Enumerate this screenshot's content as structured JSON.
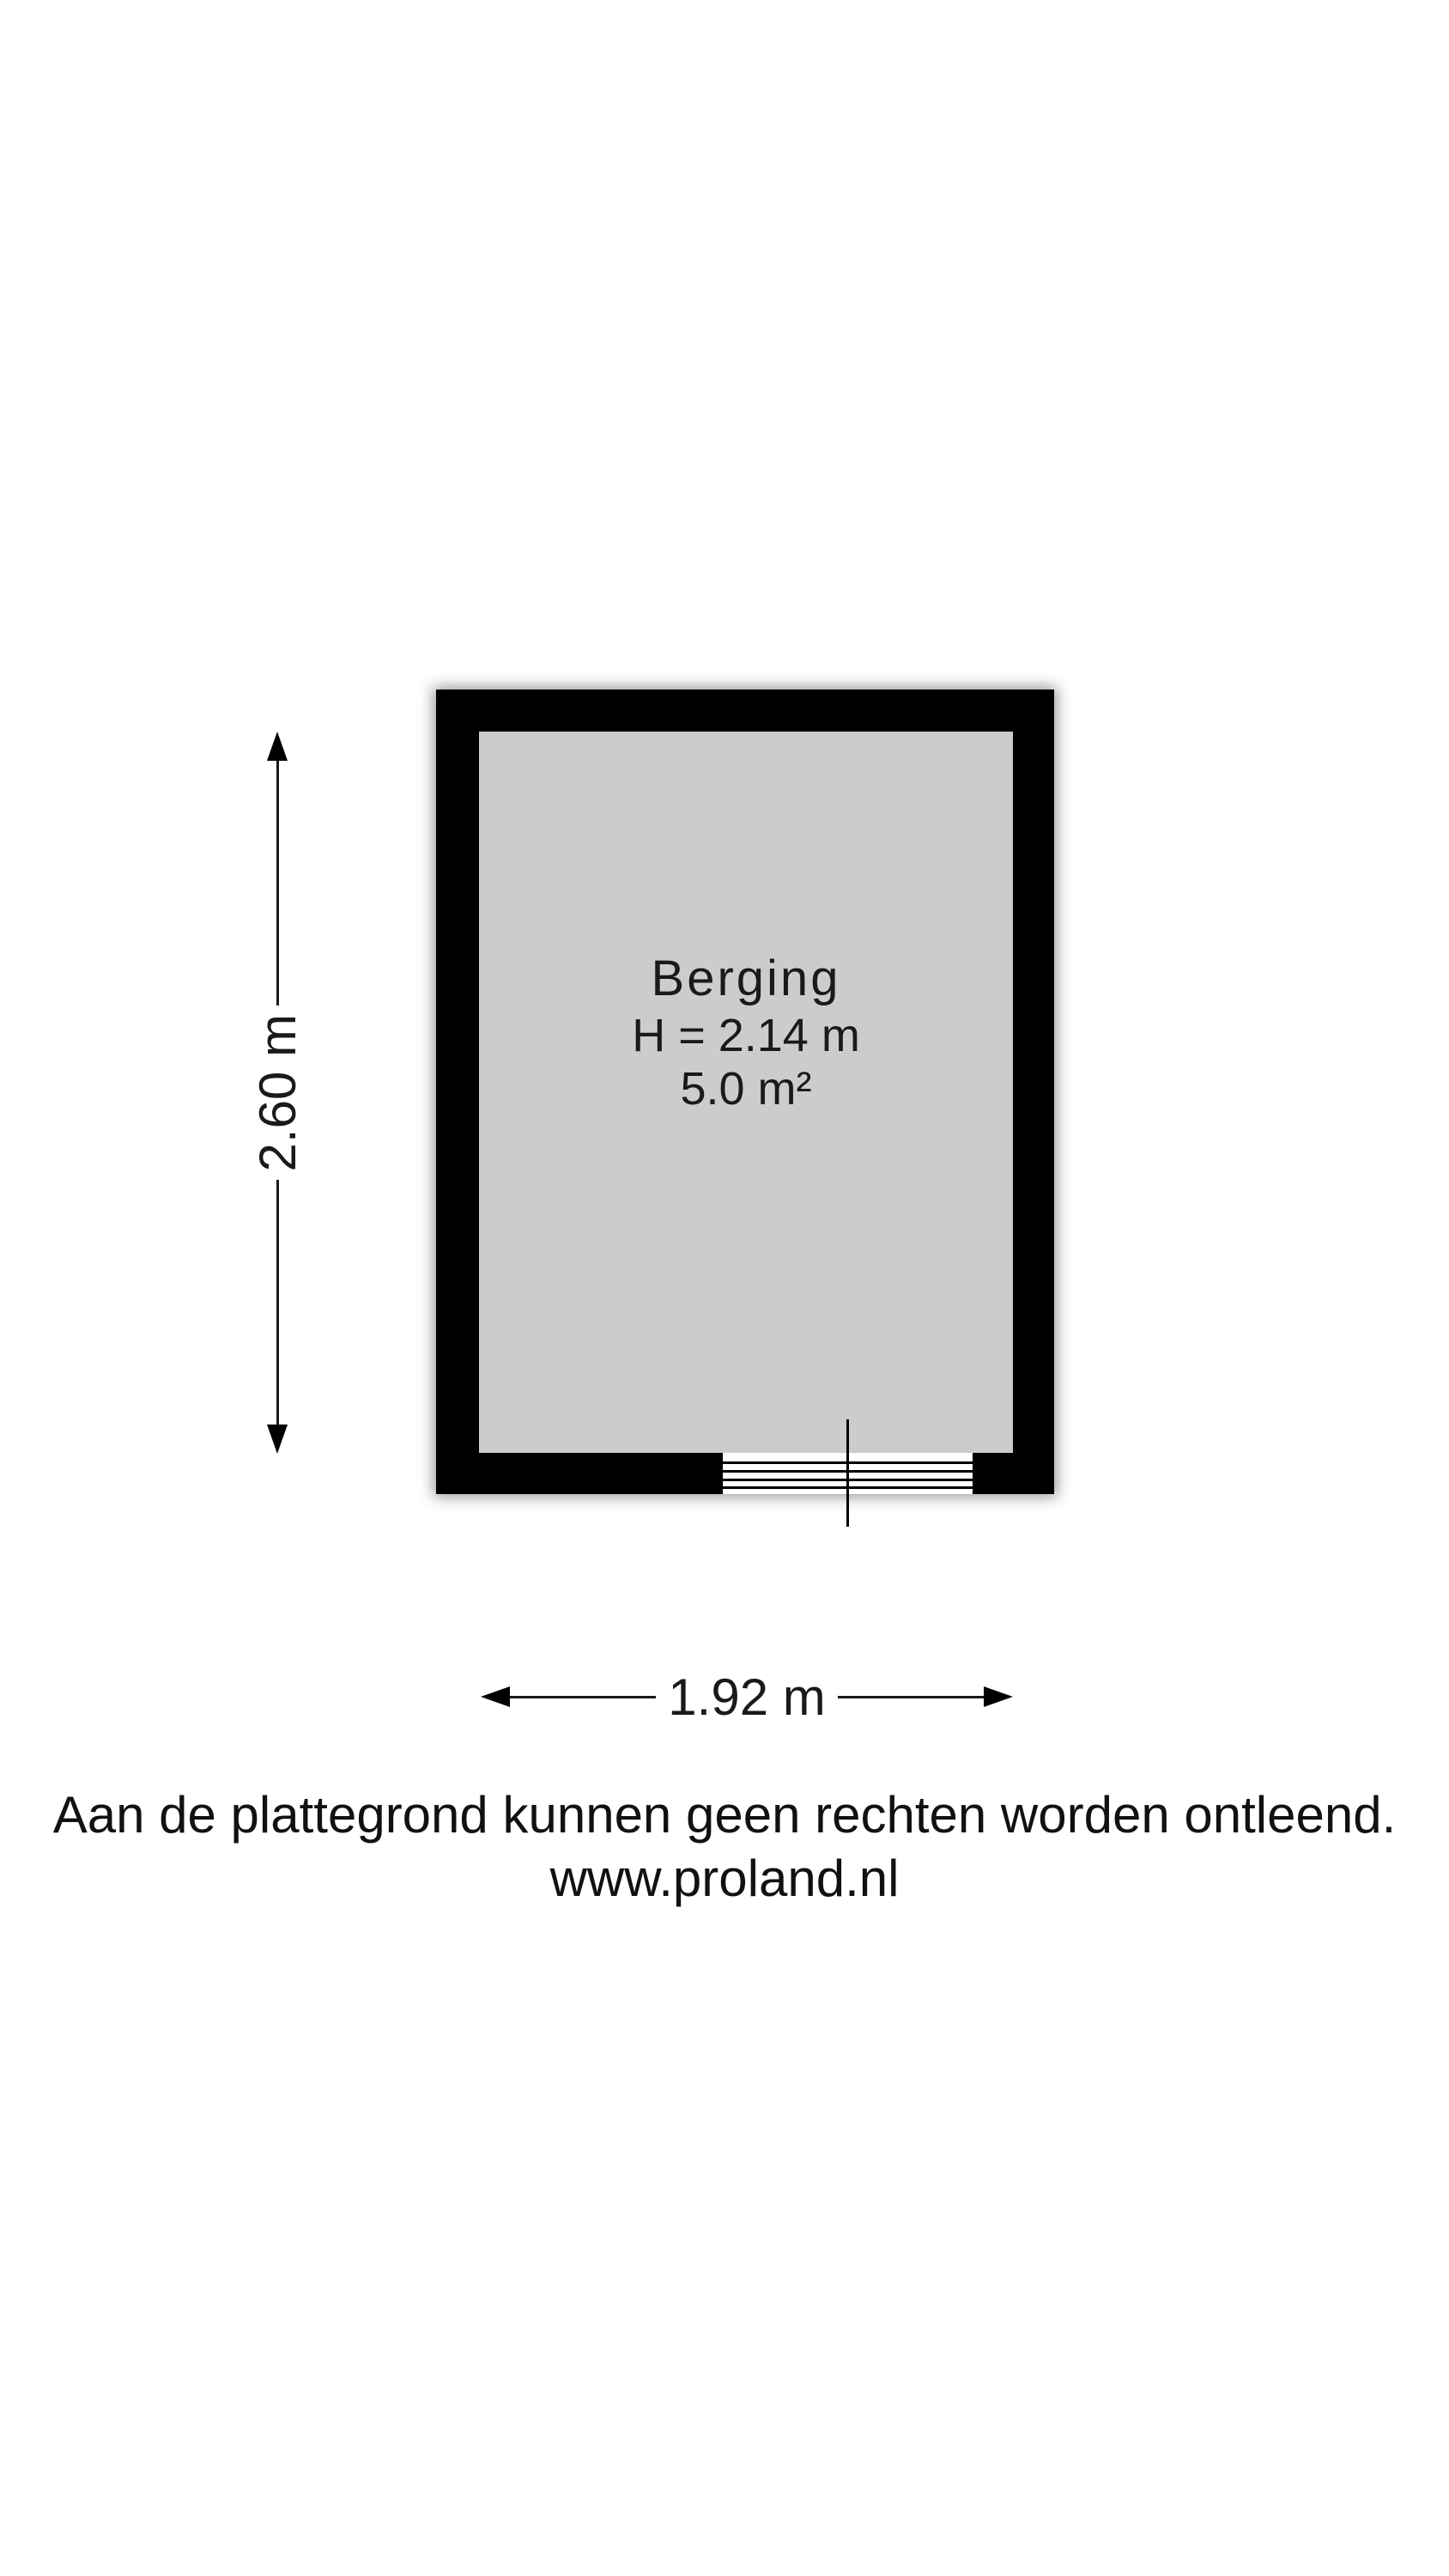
{
  "plan": {
    "room_name": "Berging",
    "room_height": "H = 2.14 m",
    "room_area": "5.0 m²",
    "dim_vertical": "2.60 m",
    "dim_horizontal": "1.92 m",
    "colors": {
      "wall": "#000000",
      "floor": "#cccccc",
      "background": "#ffffff"
    }
  },
  "footer": {
    "disclaimer": "Aan de plattegrond kunnen geen rechten worden ontleend.",
    "website": "www.proland.nl"
  }
}
